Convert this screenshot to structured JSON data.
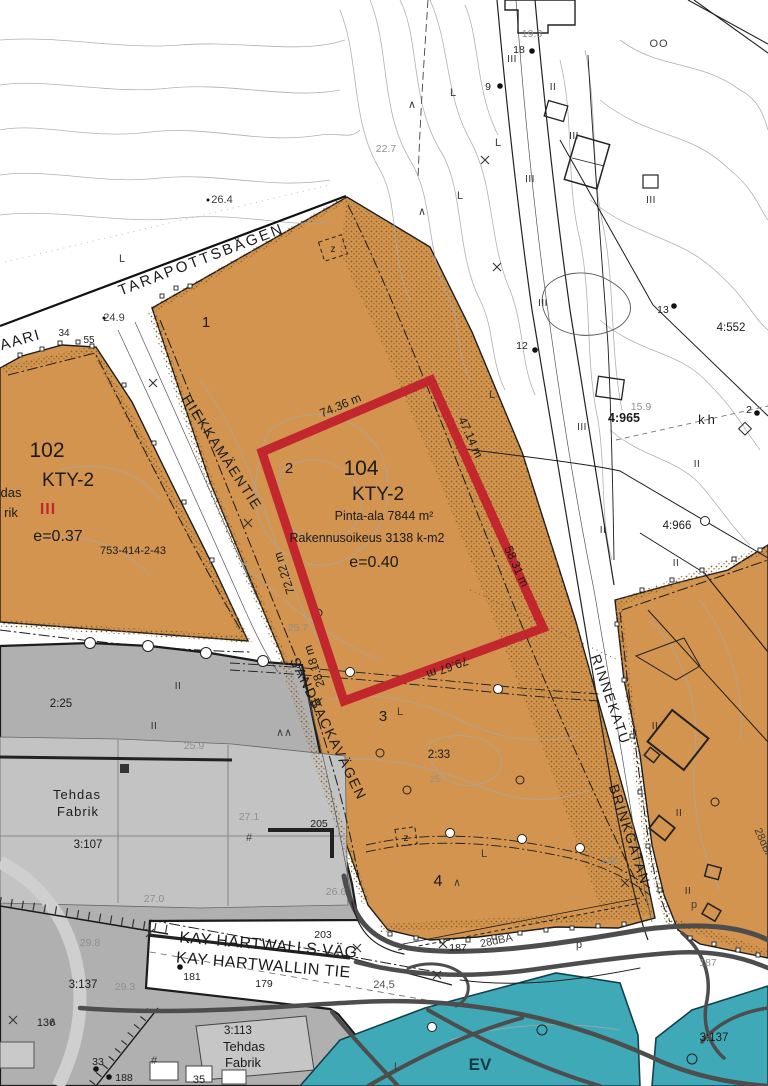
{
  "streets": {
    "tarapottsbagen": "TARAPOTTSBÅGEN",
    "kaari": "KAARI",
    "hiekkamaentie": "HIEKKAMÄENTIE",
    "sandbackavagen": "SANDBACKAVÄGEN",
    "rinnekatu": "RINNEKATU",
    "brinkgatan": "BRINKGATAN",
    "kay_hartwalls_vag": "KAY HARTWALLS VÄG",
    "kay_hartwallin_tie": "KAY HARTWALLIN TIE"
  },
  "district_102": {
    "number": "102",
    "zoning": "KTY-2",
    "storeys": "III",
    "efficiency": "e=0.37",
    "parcel_id": "753-414-2-43"
  },
  "district_104": {
    "number": "104",
    "zoning": "KTY-2",
    "area": "Pinta-ala 7844 m²",
    "building_right": "Rakennusoikeus 3138 k-m2",
    "efficiency": "e=0.40"
  },
  "plot_numbers": {
    "p1": "1",
    "p2": "2",
    "p3": "3",
    "p4": "4"
  },
  "parcels": {
    "r2_25": "2:25",
    "r2_33": "2:33",
    "r3_107": "3:107",
    "r3_113": "3:113",
    "r3_137": "3:137",
    "r4_552": "4:552",
    "r4_965": "4:965",
    "r4_966": "4:966",
    "kh": "kh"
  },
  "buildings": {
    "tehdas": "Tehdas",
    "fabrik": "Fabrik",
    "tehdas_clipped": "das",
    "fabrik_clipped": "rik"
  },
  "measurements": {
    "m1": "74.36 m",
    "m2": "47.14 m",
    "m3": "58.31 m",
    "m4": "79.67 m",
    "m5": "72.22 m",
    "m6": "28.18 m"
  },
  "elevations": {
    "e26_4": "26.4",
    "e22_7": "22.7",
    "e24_9": "24.9",
    "e25_7": "25.7",
    "e25_9": "25.9",
    "e27_1": "27.1",
    "e27_0": "27.0",
    "e29_8": "29.8",
    "e29_3": "29.3",
    "e24_5": "24,5",
    "e19_3": "19.3",
    "e15_9": "15.9",
    "e25": "25",
    "e26_6": "26.6"
  },
  "numbers": {
    "n34": "34",
    "n55": "55",
    "n9": "9",
    "n18": "18",
    "n12": "12",
    "n13": "13",
    "n2": "2",
    "n181": "181",
    "n179": "179",
    "n205": "205",
    "n203": "203",
    "n136": "136",
    "n33": "33",
    "n188": "188",
    "n35": "35",
    "n187": "187",
    "n126": "126"
  },
  "noise": {
    "label": "28dBA"
  },
  "zone_ev": {
    "label": "EV"
  },
  "symbols": {
    "l": "L",
    "oo": "OO",
    "z": "z",
    "ii": "II",
    "iii": "III",
    "tree": "∧",
    "tree2": "∧∧",
    "p": "p",
    "hash": "#"
  },
  "colors": {
    "plot_orange": "#D2944E",
    "reserve_teal": "#3FA9B8",
    "industrial_gray": "#B0B0B0",
    "highlight_red": "#C1272D",
    "contour_gray": "#A8A8A8"
  }
}
